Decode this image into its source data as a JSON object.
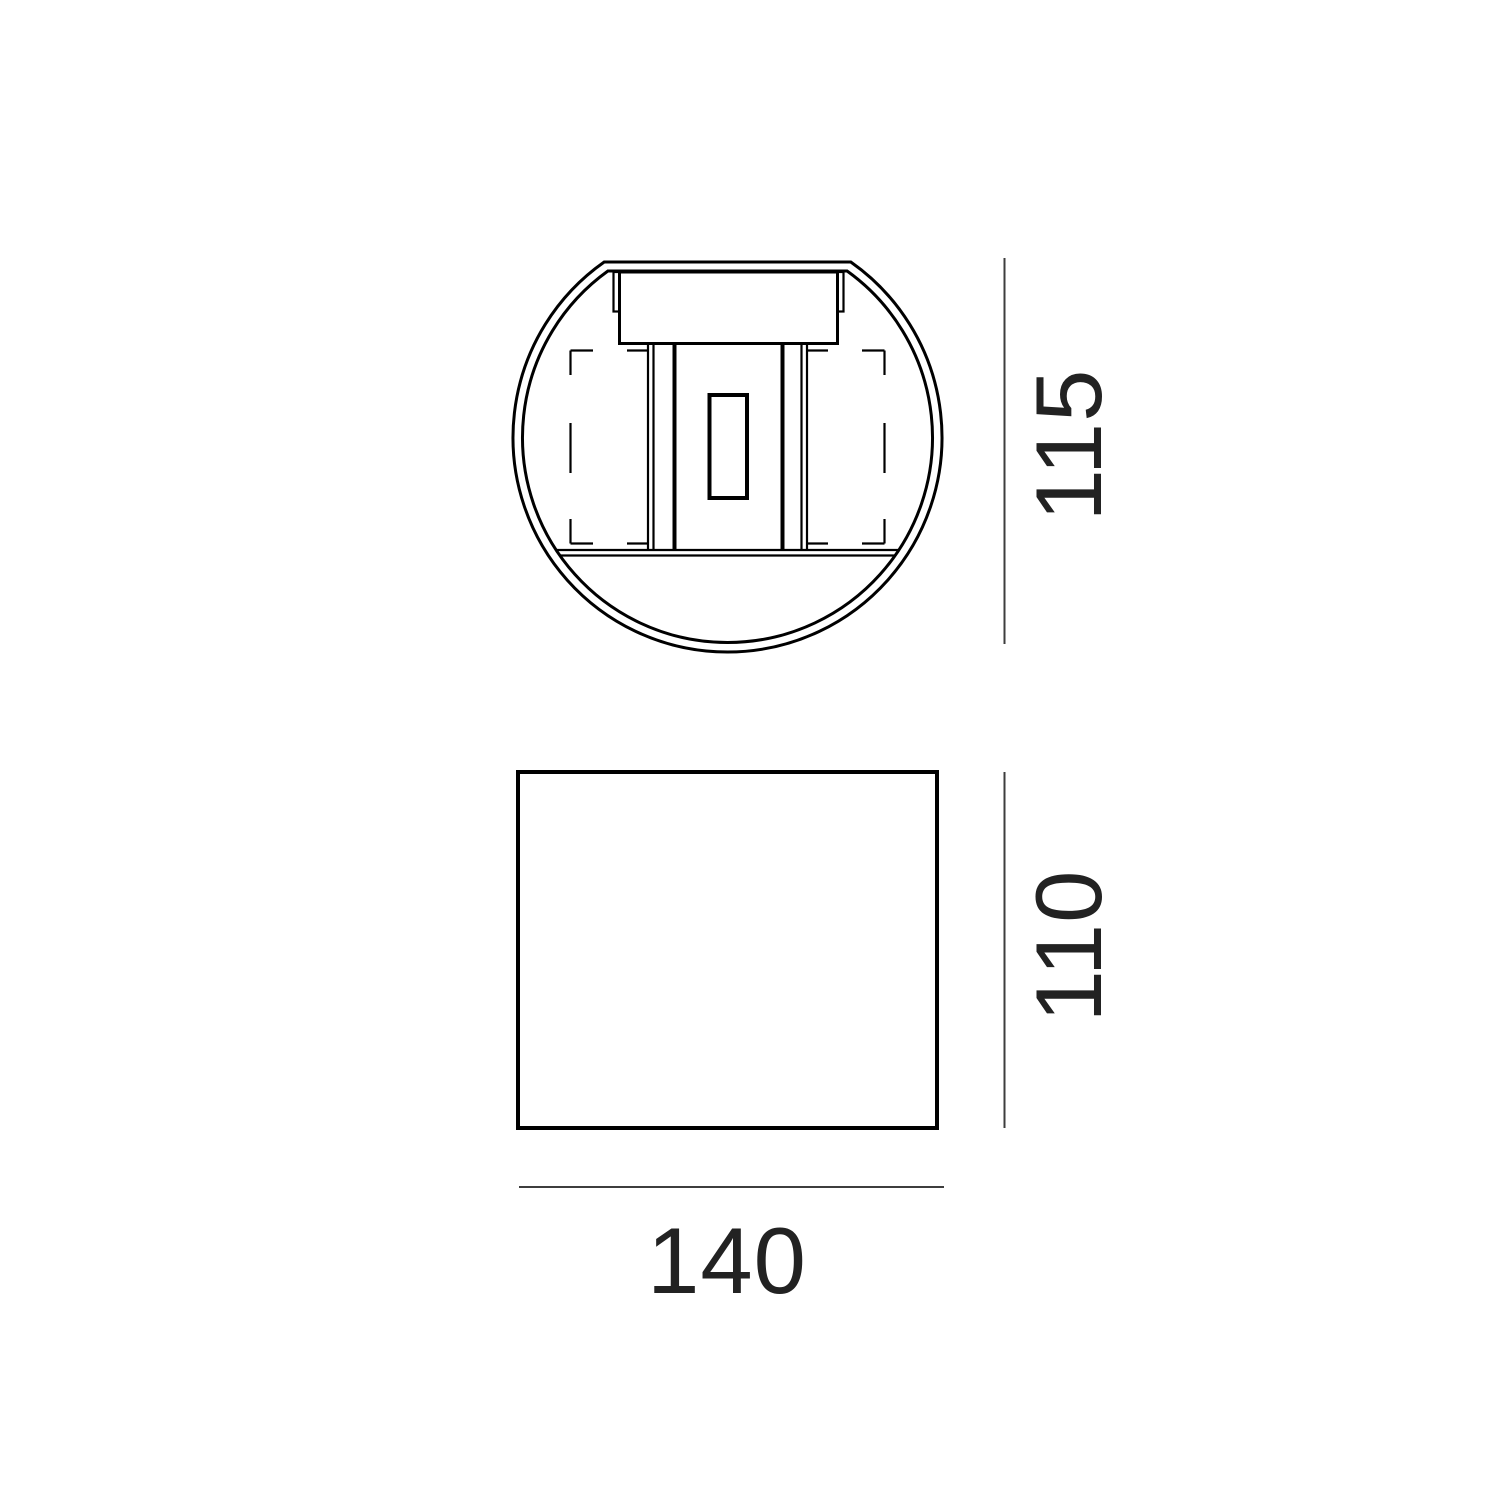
{
  "colors": {
    "background": "#ffffff",
    "drawing_line": "#000000",
    "dimension_line": "#3d3d3d",
    "dimension_text": "#222222"
  },
  "dimensions": {
    "top_view_height": "115",
    "front_view_height": "110",
    "front_view_width": "140"
  }
}
